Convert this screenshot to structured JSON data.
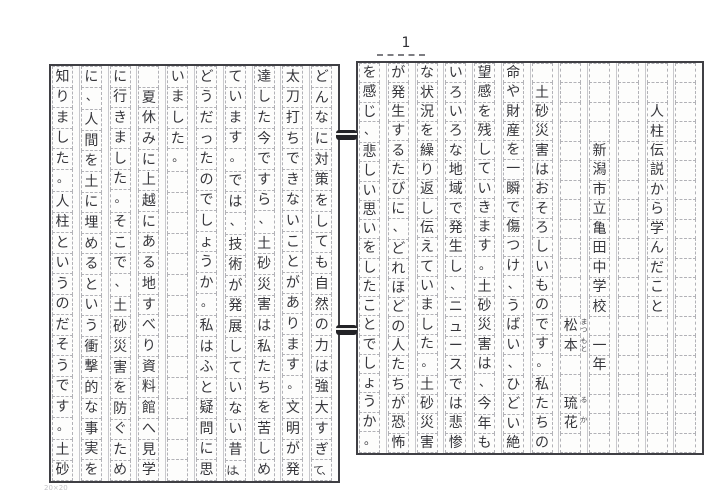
{
  "page_label": "1",
  "sheet_mark": "20×20",
  "meta": {
    "title": "人柱伝説から学んだこと",
    "school": "新潟市立亀田中学校",
    "grade": "一年",
    "author_surname": "松本",
    "author_given": "琉花",
    "furigana_surname": "まつもと",
    "furigana_given": "るか"
  },
  "colors": {
    "ink": "#36363b",
    "grid_line": "#b2b2b7",
    "page_border": "#3f3f44",
    "paper": "#fdfdfc"
  },
  "right_page": {
    "columns": [
      {
        "name": "margin-column",
        "text": ""
      },
      {
        "name": "title-column",
        "text": "　　人柱伝説から学んだこと"
      },
      {
        "name": "spacer-column",
        "text": ""
      },
      {
        "name": "school-column",
        "text": "　　　　新潟市立亀田中学校　一年"
      },
      {
        "name": "author-column",
        "text": "　　　　　　　　　　　　　松本　　琉花",
        "furigana": [
          {
            "row": 14,
            "text": "まつ"
          },
          {
            "row": 15,
            "text": "もと"
          },
          {
            "row": 18,
            "text": "る"
          },
          {
            "row": 19,
            "text": "か"
          }
        ]
      },
      {
        "name": "body-column-1",
        "text": "　土砂災害はおそろしいものです。私たちの"
      },
      {
        "name": "body-column-2",
        "text": "命や財産を一瞬で傷つけ、うばい、ひどい絶"
      },
      {
        "name": "body-column-3",
        "text": "望感を残していきます。土砂災害は、今年も"
      },
      {
        "name": "body-column-4",
        "text": "いろいろな地域で発生し、ニュースでは悲惨"
      },
      {
        "name": "body-column-5",
        "text": "な状況を繰り返し伝えていました。土砂災害"
      },
      {
        "name": "body-column-6",
        "text": "が発生するたびに、どれほどの人たちが恐怖"
      },
      {
        "name": "body-column-7",
        "text": "を感じ、悲しい思いをしたことでしょうか。"
      }
    ]
  },
  "left_page": {
    "columns": [
      {
        "name": "body-column-8",
        "text": "どんなに対策をしても自然の力は強大すぎて、"
      },
      {
        "name": "body-column-9",
        "text": "太刀打ちできないことがあります。文明が発"
      },
      {
        "name": "body-column-10",
        "text": "達した今ですら、土砂災害は私たちを苦しめ"
      },
      {
        "name": "body-column-11",
        "text": "ています。では、技術が発展していない昔は、"
      },
      {
        "name": "body-column-12",
        "text": "どうだったのでしょうか。私はふと疑問に思"
      },
      {
        "name": "body-column-13",
        "text": "いました。"
      },
      {
        "name": "body-column-14",
        "text": "　夏休みに上越にある地すべり資料館へ見学"
      },
      {
        "name": "body-column-15",
        "text": "に行きました。そこで、土砂災害を防ぐため"
      },
      {
        "name": "body-column-16",
        "text": "に、人間を土に埋めるという衝撃的な事実を"
      },
      {
        "name": "body-column-17",
        "text": "知りました。人柱というのだそうです。土砂"
      }
    ]
  }
}
